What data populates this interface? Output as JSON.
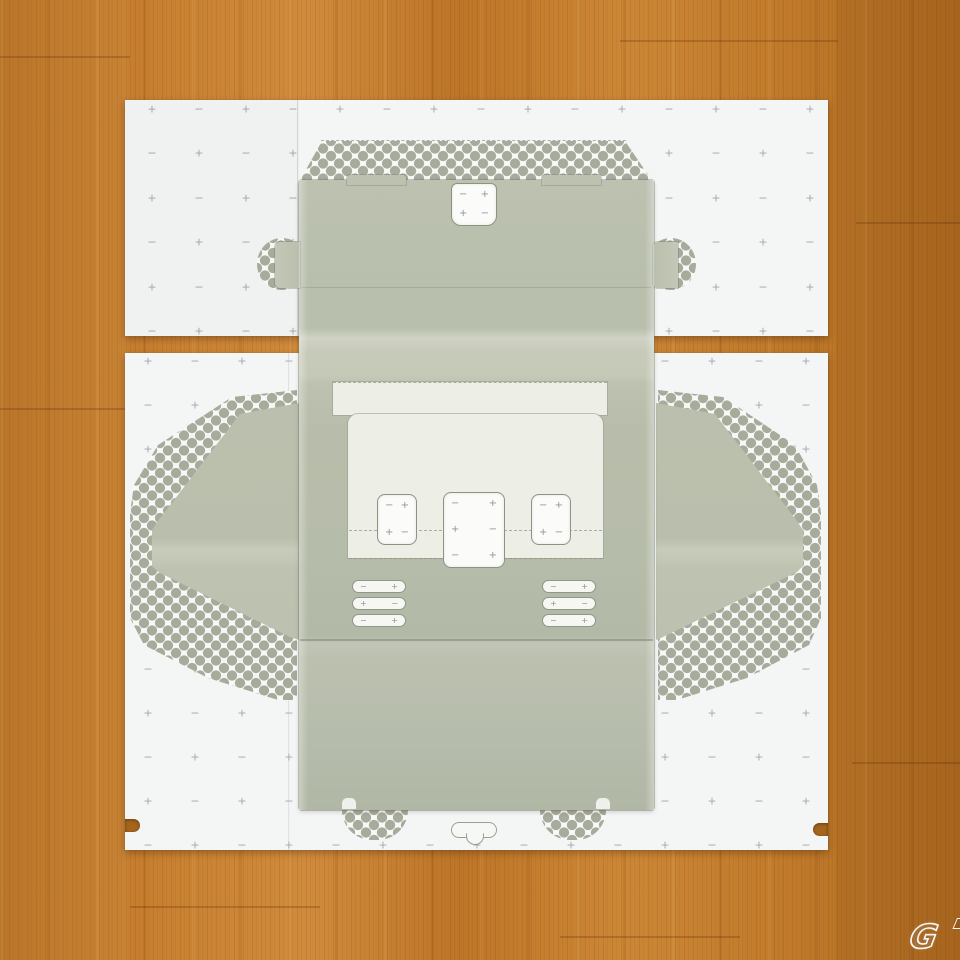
{
  "scene": {
    "description": "Unfolded light-olive cardboard box template lying on two white die-cut backing sheets printed with plus/minus registration marks and halftone dot zones, photographed on an orange wooden table",
    "colors": {
      "wood": "#c07b2e",
      "wood_dark": "#9c5d1c",
      "wood_light": "#d69a4e",
      "sheet": "#f4f6f6",
      "cardboard": "#bcc0af",
      "cardboard_light": "#c7cabb",
      "inset": "#edeee6",
      "cutout_white": "#fbfcf9",
      "dot": "#a6ab9c",
      "mark": "#98a0a6",
      "outline": "#8d9384"
    }
  },
  "registration_marks": {
    "plus_symbol": "+",
    "minus_symbol": "−",
    "grids": [
      {
        "target": "top-sheet-marks",
        "cols": 15,
        "rows": 6,
        "ox": 27,
        "oy": 9,
        "dx": 47,
        "dy": 44.4,
        "start": "plus"
      },
      {
        "target": "bottom-sheet-marks",
        "cols": 15,
        "rows": 12,
        "ox": 23,
        "oy": 8,
        "dx": 47,
        "dy": 44,
        "start": "plus"
      }
    ]
  },
  "cutouts": {
    "top_tab": {
      "rows": [
        [
          "−",
          "+"
        ],
        [
          "+",
          "−"
        ]
      ]
    },
    "left_square": {
      "rows": [
        [
          "−",
          "+"
        ],
        [
          "+",
          "−"
        ]
      ]
    },
    "center_square": {
      "rows": [
        [
          "−",
          "+"
        ],
        [
          "+",
          "−"
        ],
        [
          "−",
          "+"
        ]
      ]
    },
    "right_square": {
      "rows": [
        [
          "−",
          "+"
        ],
        [
          "+",
          "−"
        ]
      ]
    }
  },
  "vents": {
    "left": {
      "pills": [
        [
          "−",
          "+"
        ],
        [
          "+",
          "−"
        ],
        [
          "−",
          "+"
        ]
      ]
    },
    "right": {
      "pills": [
        [
          "−",
          "+"
        ],
        [
          "+",
          "−"
        ],
        [
          "−",
          "+"
        ]
      ]
    }
  },
  "watermark": {
    "text": "G"
  }
}
